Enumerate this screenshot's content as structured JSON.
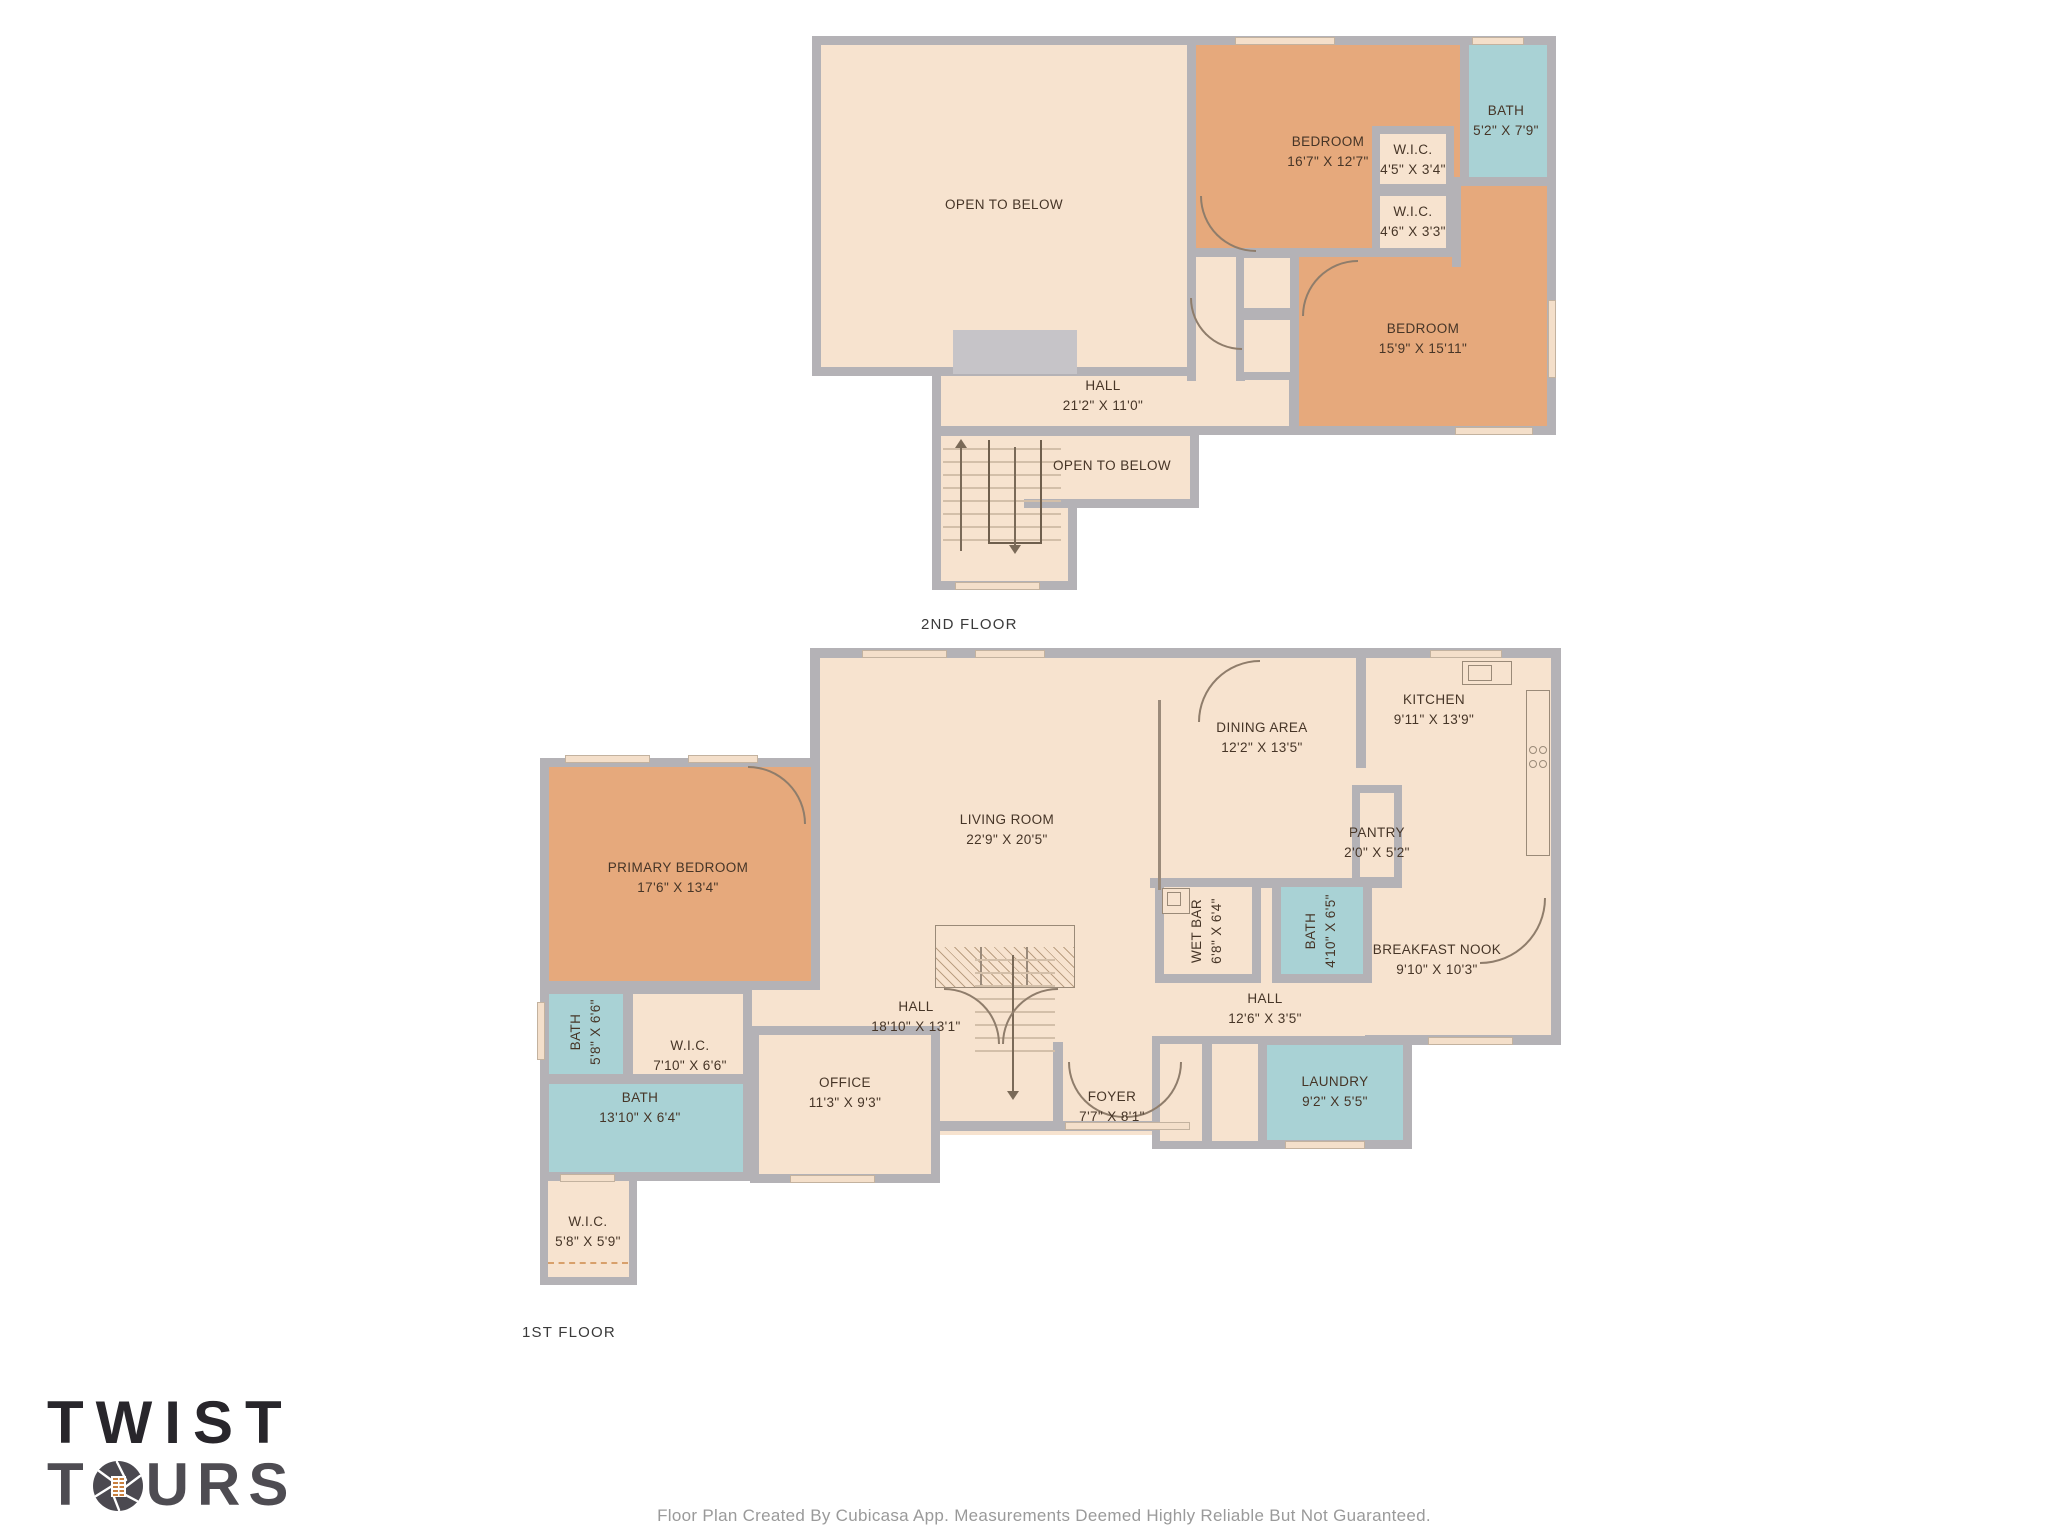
{
  "colors": {
    "wall": "#b4b2b6",
    "room_cream": "#f7e3cf",
    "room_orange": "#e6a97c",
    "room_blue": "#a9d2d5",
    "hatch_gray": "#c6c4c8",
    "label_text": "#463527",
    "floor_label_text": "#3a3a3a",
    "footer_text": "#9a9a9a",
    "logo_dark": "#28262b",
    "logo_gray": "#4e4c52",
    "logo_orange": "#c9803f"
  },
  "second_floor": {
    "title": "2ND FLOOR",
    "rooms": {
      "open_below": {
        "name": "OPEN TO BELOW"
      },
      "bedroom_front": {
        "name": "BEDROOM",
        "dims": "16'7\" X 12'7\""
      },
      "bath": {
        "name": "BATH",
        "dims": "5'2\" X 7'9\""
      },
      "wic_a": {
        "name": "W.I.C.",
        "dims": "4'5\" X 3'4\""
      },
      "wic_b": {
        "name": "W.I.C.",
        "dims": "4'6\" X 3'3\""
      },
      "bedroom_back": {
        "name": "BEDROOM",
        "dims": "15'9\" X 15'11\""
      },
      "hall": {
        "name": "HALL",
        "dims": "21'2\" X 11'0\""
      },
      "stair_opening": {
        "name": "OPEN TO BELOW"
      }
    }
  },
  "first_floor": {
    "title": "1ST FLOOR",
    "rooms": {
      "living_room": {
        "name": "LIVING ROOM",
        "dims": "22'9\" X 20'5\""
      },
      "dining_area": {
        "name": "DINING AREA",
        "dims": "12'2\" X 13'5\""
      },
      "kitchen": {
        "name": "KITCHEN",
        "dims": "9'11\" X 13'9\""
      },
      "pantry": {
        "name": "PANTRY",
        "dims": "2'0\" X 5'2\""
      },
      "wet_bar": {
        "name": "WET BAR",
        "dims": "6'8\" X 6'4\""
      },
      "hall_bath": {
        "name": "BATH",
        "dims": "4'10\" X 6'5\""
      },
      "breakfast_nook": {
        "name": "BREAKFAST NOOK",
        "dims": "9'10\" X 10'3\""
      },
      "hall_small": {
        "name": "HALL",
        "dims": "12'6\" X 3'5\""
      },
      "hall_main": {
        "name": "HALL",
        "dims": "18'10\" X 13'1\""
      },
      "foyer": {
        "name": "FOYER",
        "dims": "7'7\" X 8'1\""
      },
      "laundry": {
        "name": "LAUNDRY",
        "dims": "9'2\" X 5'5\""
      },
      "primary_bedroom": {
        "name": "PRIMARY BEDROOM",
        "dims": "17'6\" X 13'4\""
      },
      "primary_bath": {
        "name": "BATH",
        "dims": "5'8\" X 6'6\""
      },
      "primary_wic": {
        "name": "W.I.C.",
        "dims": "7'10\" X 6'6\""
      },
      "main_bath": {
        "name": "BATH",
        "dims": "13'10\" X 6'4\""
      },
      "lower_wic": {
        "name": "W.I.C.",
        "dims": "5'8\" X 5'9\""
      },
      "office": {
        "name": "OFFICE",
        "dims": "11'3\" X 9'3\""
      }
    }
  },
  "branding": {
    "logo_line1": "TWIST",
    "logo_line2_start": "T",
    "logo_line2_end": "URS"
  },
  "footer": {
    "disclaimer": "Floor Plan Created By Cubicasa App. Measurements Deemed Highly Reliable But Not Guaranteed."
  }
}
